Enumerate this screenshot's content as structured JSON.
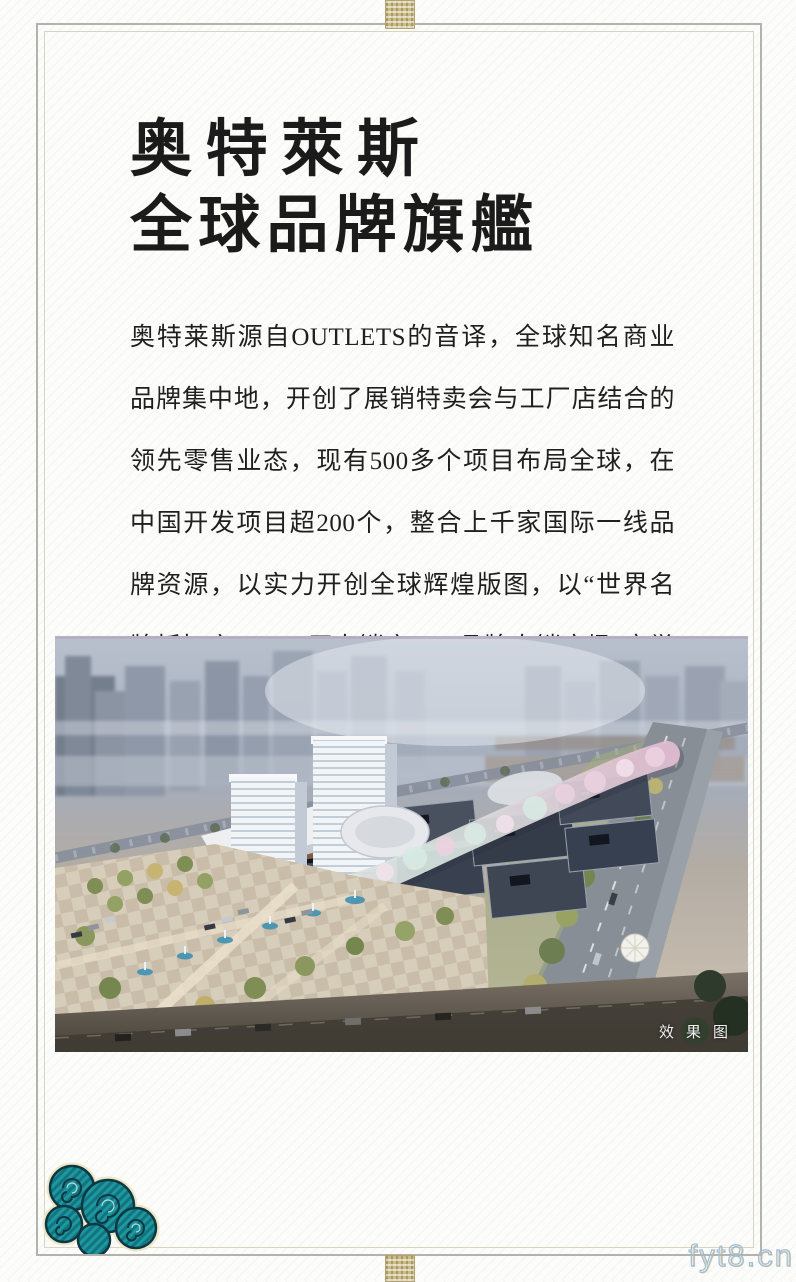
{
  "header": {
    "title_line1": "奥特萊斯",
    "title_line2": "全球品牌旗艦"
  },
  "body": {
    "paragraph": "奥特莱斯源自OUTLETS的音译，全球知名商业品牌集中地，开创了展销特卖会与工厂店结合的领先零售业态，现有500多个项目布局全球，在中国开发项目超200个，整合上千家国际一线品牌资源，以实力开创全球辉煌版图，以“世界名牌折扣店”、“工厂直销店”、“品牌直销广场”享誉全球。"
  },
  "rendering": {
    "caption": "效果图"
  },
  "watermark": {
    "text": "fyt8.cn"
  },
  "icons": {
    "cloud_ornament": "auspicious-cloud",
    "frame_knot_top": "brocade-knot",
    "frame_knot_bottom": "brocade-knot"
  },
  "colors": {
    "frame_outer": "#b3b2ab",
    "frame_inner": "#d8d4c2",
    "title_text": "#1b1b1b",
    "body_text": "#1f1f1f",
    "cloud_teal": "#1d98a0",
    "cloud_outline": "#0c3844",
    "cloud_trim": "#efe6c8",
    "caption_text": "#f0f0f0",
    "watermark_stroke": "#9fbcd2"
  }
}
